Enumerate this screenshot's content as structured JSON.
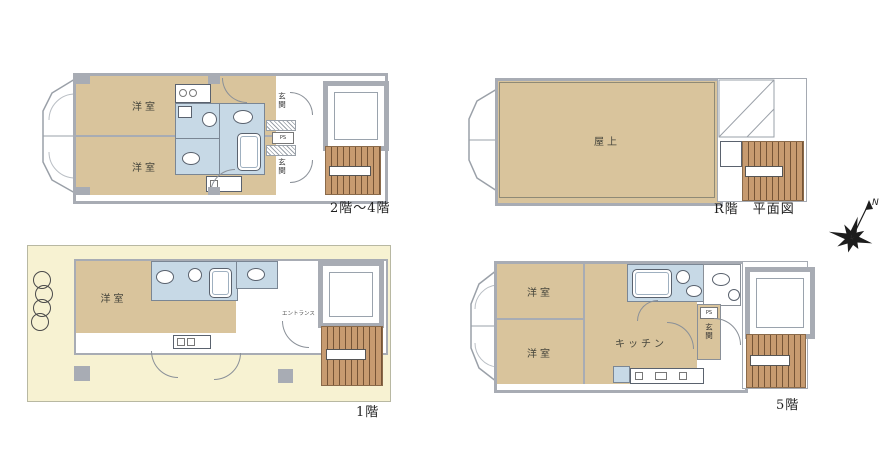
{
  "sheet": {
    "background": "#ffffff"
  },
  "colors": {
    "room_tan": "#d9c49c",
    "wet_blue": "#c7d9e6",
    "wall": "#a8acb4",
    "stairs_brown": "#c79b70",
    "site_yellow": "#f7f2d2"
  },
  "plans": {
    "floor_2_4": {
      "caption": "2階〜4階",
      "room_top": "洋室",
      "room_bottom": "洋室",
      "entrance_top": "玄関",
      "entrance_bottom": "玄関",
      "pipe_space": "PS"
    },
    "roof": {
      "caption": "R階　平面図",
      "room": "屋上"
    },
    "floor_1": {
      "caption": "1階",
      "room": "洋室",
      "entrance": "エントランス"
    },
    "floor_5": {
      "caption": "5階",
      "room_top": "洋室",
      "room_bottom": "洋室",
      "kitchen": "キッチン",
      "entrance": "玄関",
      "pipe_space": "PS"
    }
  },
  "compass": {
    "north": "N"
  }
}
